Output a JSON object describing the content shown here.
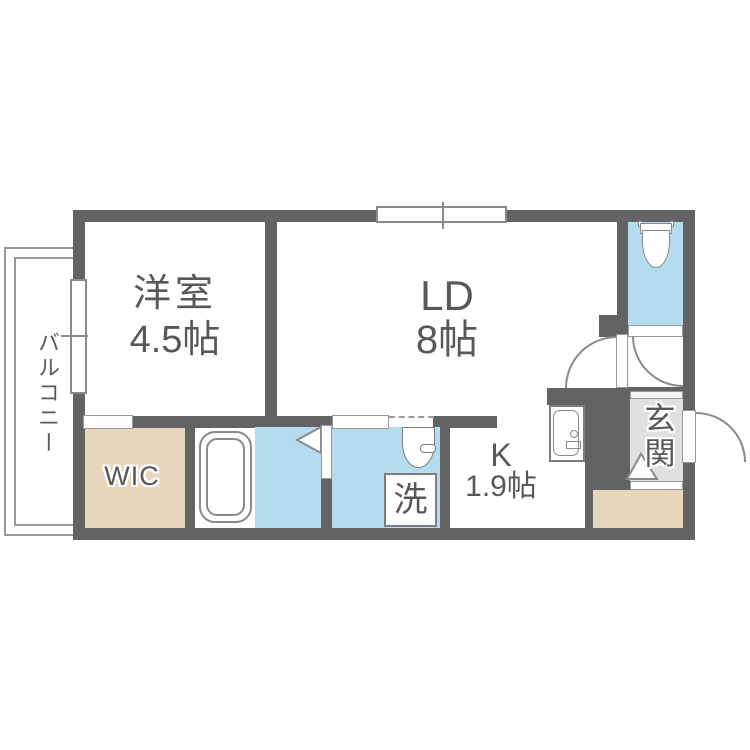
{
  "title": "1LDK floor plan",
  "colors": {
    "wall": "#636363",
    "water": "#b5dcee",
    "wood": "#e6d6bb",
    "genkan": "#e0e0e0",
    "text": "#585858"
  },
  "rooms": {
    "western": {
      "name": "洋室",
      "size": "4.5帖"
    },
    "living": {
      "name": "LD",
      "size": "8帖"
    },
    "kitchen": {
      "name": "K",
      "size": "1.9帖"
    },
    "wic": {
      "name": "WIC"
    },
    "balcony": {
      "name": "バルコニー"
    },
    "genkan": {
      "name": "玄関"
    },
    "laundry": {
      "name": "洗"
    }
  }
}
